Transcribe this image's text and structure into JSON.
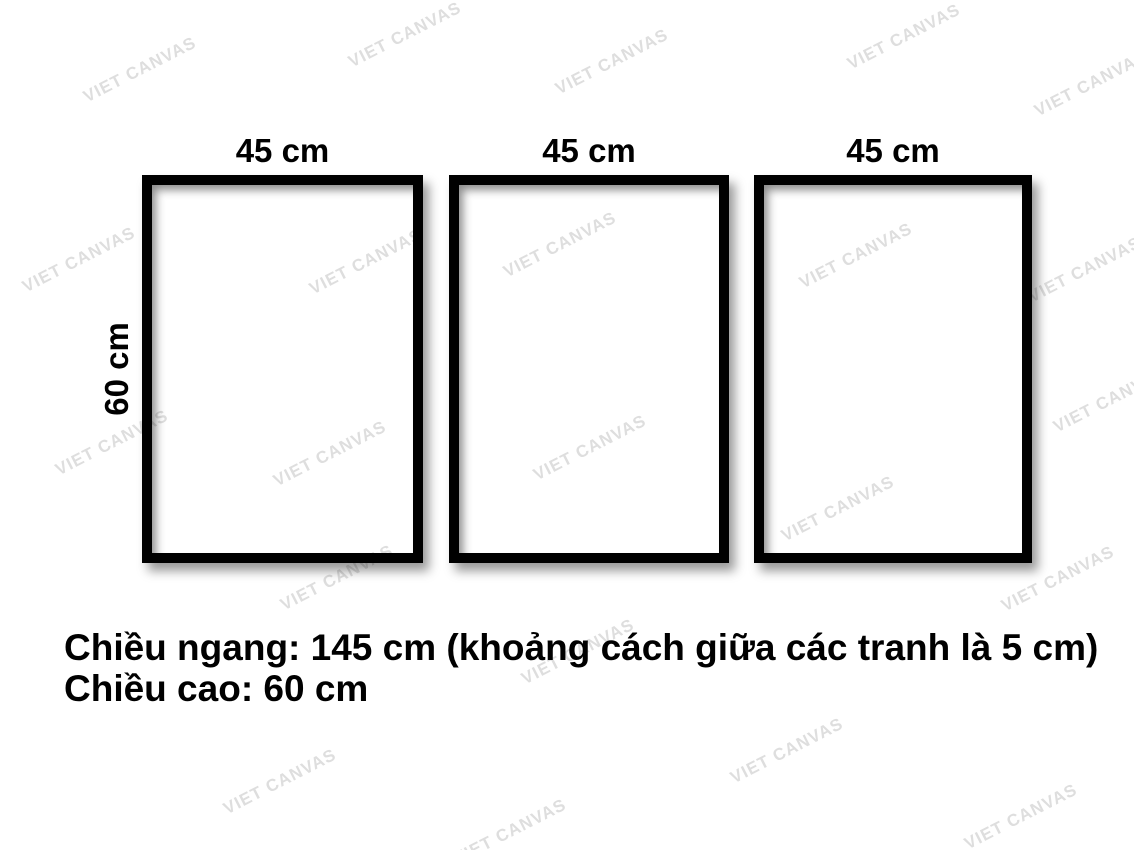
{
  "colors": {
    "background": "#ffffff",
    "frame_border": "#000000",
    "text": "#000000",
    "watermark": "#dedede"
  },
  "frames": [
    {
      "width_label": "45 cm"
    },
    {
      "width_label": "45 cm"
    },
    {
      "width_label": "45 cm"
    }
  ],
  "height_label": "60 cm",
  "caption": {
    "line1": "Chiều ngang: 145 cm (khoảng cách giữa các tranh là 5 cm)",
    "line2": "Chiều cao: 60 cm"
  },
  "watermark": {
    "text": "VIET CANVAS"
  }
}
